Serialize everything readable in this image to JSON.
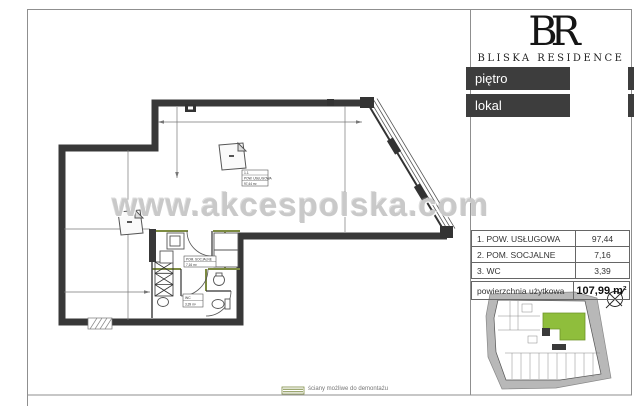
{
  "branding": {
    "logo": "BR",
    "name": "BLISKA RESIDENCE"
  },
  "sidebar": {
    "floor_field_label": "piętro",
    "unit_field_label": "lokal",
    "area_table": {
      "rows": [
        {
          "name": "1. POW. USŁUGOWA",
          "value": "97,44"
        },
        {
          "name": "2. POM. SOCJALNE",
          "value": "7,16"
        },
        {
          "name": "3. WC",
          "value": "3,39"
        }
      ],
      "total_label": "powierzchnia użytkowa",
      "total_value": "107,99 m²"
    }
  },
  "watermark": "www.akcespolska.com",
  "legend": {
    "demountable_walls": "ściany możliwe do demontażu"
  },
  "plan": {
    "room1_label": {
      "no": "1.1",
      "name": "POW. USŁUGOWA",
      "area": "97,44 m²"
    },
    "room2_label": {
      "no": "1.2",
      "name": "POM. SOCJALNE",
      "area": "7,16 m²"
    },
    "room3_label": {
      "no": "1.3",
      "name": "WC",
      "area": "3,39 m²"
    }
  },
  "colors": {
    "wall": "#383838",
    "bar_dark": "#3d3d3d",
    "accent_green": "#8fbe3c",
    "demountable_olive": "#7d8b42"
  }
}
